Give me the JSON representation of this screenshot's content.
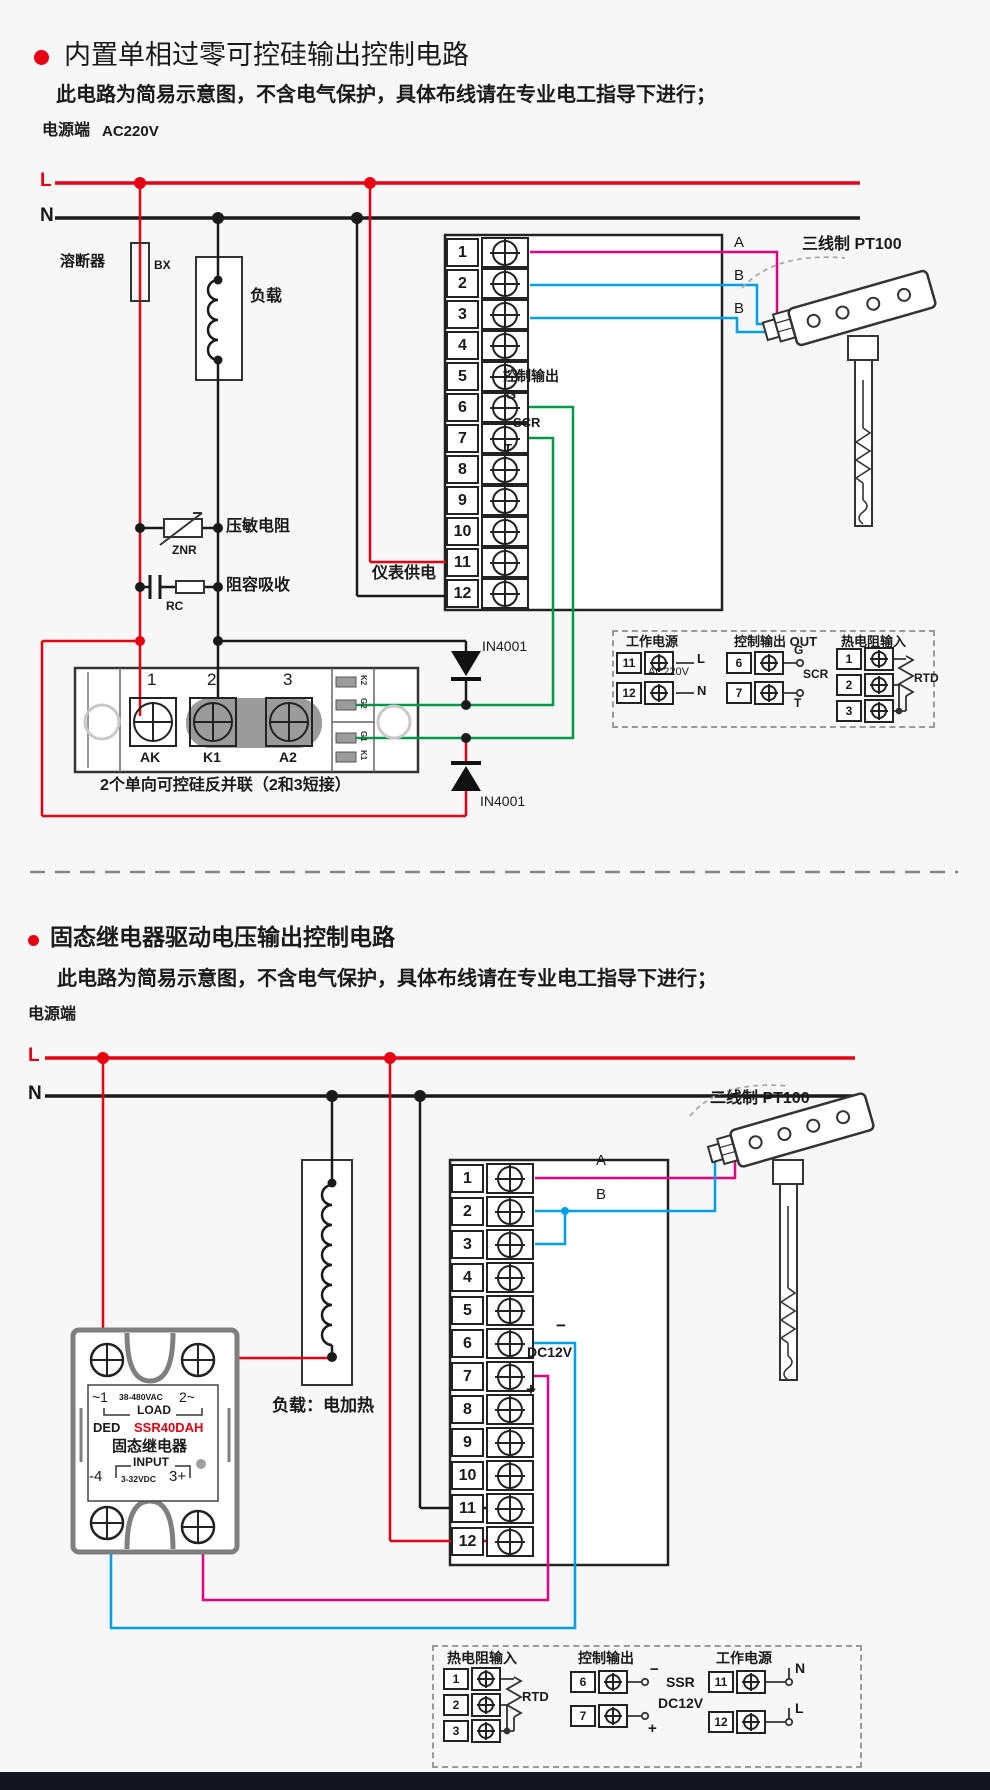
{
  "colors": {
    "accent_red": "#e60012",
    "wire_black": "#1a1a1a",
    "wire_magenta": "#e4007f",
    "wire_blue": "#00a0e9",
    "wire_green": "#009944",
    "module_gray": "#9b9b9b"
  },
  "c1": {
    "title": "内置单相过零可控硅输出控制电路",
    "subtitle": "此电路为简易示意图，不含电气保护，具体布线请在专业电工指导下进行；",
    "power_label": "电源端",
    "voltage": "AC220V",
    "line_l": "L",
    "line_n": "N",
    "fuse_label": "溶断器",
    "fuse_code": "BX",
    "load_label": "负载",
    "varistor_label": "压敏电阻",
    "varistor_code": "ZNR",
    "rc_label": "阻容吸收",
    "rc_code": "RC",
    "meter_supply": "仪表供电",
    "terminals": [
      "1",
      "2",
      "3",
      "4",
      "5",
      "6",
      "7",
      "8",
      "9",
      "10",
      "11",
      "12"
    ],
    "wire_a": "A",
    "wire_b1": "B",
    "wire_b2": "B",
    "control_output": "控制输出",
    "g": "G",
    "scr": "SCR",
    "t": "T",
    "sensor_label": "三线制 PT100",
    "diode_top": "IN4001",
    "diode_bottom": "IN4001",
    "module": {
      "n1": "1",
      "n2": "2",
      "n3": "3",
      "p1": "AK",
      "p2": "K1",
      "p3": "A2",
      "side": [
        "K2",
        "G2",
        "G1",
        "K1"
      ],
      "caption": "2个单向可控硅反并联（2和3短接）"
    },
    "legend": {
      "s1": {
        "title": "工作电源",
        "r1n": "11",
        "r1l": "L",
        "mid": "AC220V",
        "r2n": "12",
        "r2l": "N"
      },
      "s2": {
        "title": "控制输出 OUT",
        "r1n": "6",
        "r1l": "G",
        "mid": "SCR",
        "r2n": "7",
        "r2l": "T"
      },
      "s3": {
        "title": "热电阻输入",
        "n1": "1",
        "n2": "2",
        "n3": "3",
        "mid": "RTD"
      }
    }
  },
  "c2": {
    "title": "固态继电器驱动电压输出控制电路",
    "subtitle": "此电路为简易示意图，不含电气保护，具体布线请在专业电工指导下进行；",
    "power_label": "电源端",
    "line_l": "L",
    "line_n": "N",
    "load_caption": "负载：电加热",
    "ssr": {
      "ac_l": "~1",
      "ac_mid": "38-480VAC",
      "ac_r": "2~",
      "load": "LOAD",
      "brand": "DED",
      "model": "SSR40DAH",
      "name": "固态继电器",
      "input": "INPUT",
      "dc_l": "-4",
      "dc_mid": "3-32VDC",
      "dc_r": "3+"
    },
    "terminals": [
      "1",
      "2",
      "3",
      "4",
      "5",
      "6",
      "7",
      "8",
      "9",
      "10",
      "11",
      "12"
    ],
    "wire_a": "A",
    "wire_b": "B",
    "minus": "−",
    "plus": "+",
    "dc": "DC12V",
    "sensor_label": "二线制 PT100",
    "legend": {
      "s1": {
        "title": "热电阻输入",
        "n1": "1",
        "n2": "2",
        "n3": "3",
        "mid": "RTD"
      },
      "s2": {
        "title": "控制输出",
        "r1n": "6",
        "minus": "−",
        "r2n": "7",
        "plus": "+",
        "ssr": "SSR",
        "dc": "DC12V"
      },
      "s3": {
        "title": "工作电源",
        "r1n": "11",
        "r1l": "N",
        "r2n": "12",
        "r2l": "L"
      }
    }
  }
}
